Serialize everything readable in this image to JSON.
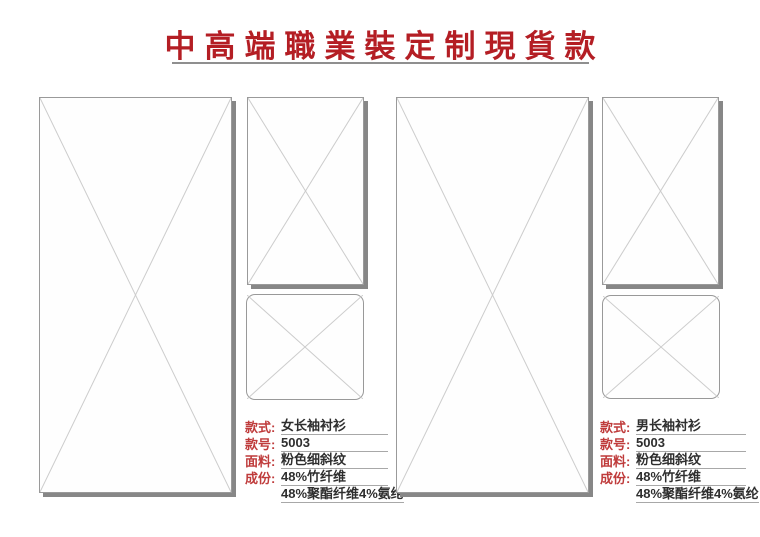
{
  "header": {
    "title": "中高端職業裝定制現貨款",
    "title_color": "#b41e24",
    "underline_color": "#8f8f8f"
  },
  "style": {
    "label_red": "#bf3b3b",
    "value_color": "#2e2e2e",
    "placeholder_border": "#9a9a9a",
    "placeholder_cross": "#cccccc",
    "placeholder_shadow": "#878787"
  },
  "placeholders": {
    "left_main": "image-placeholder",
    "left_top": "image-placeholder",
    "left_bottom": "image-placeholder-rounded",
    "right_main": "image-placeholder",
    "right_top": "image-placeholder",
    "right_bottom": "image-placeholder-rounded"
  },
  "products": [
    {
      "name": "女长袖衬衫",
      "details": [
        {
          "label": "款式:",
          "value": "女长袖衬衫"
        },
        {
          "label": "款号:",
          "value": "5003"
        },
        {
          "label": "面料:",
          "value": "粉色细斜纹"
        },
        {
          "label": "成份:",
          "value": "48%竹纤维"
        },
        {
          "label": "",
          "value": "48%聚酯纤维4%氨纶"
        }
      ]
    },
    {
      "name": "男长袖衬衫",
      "details": [
        {
          "label": "款式:",
          "value": "男长袖衬衫"
        },
        {
          "label": "款号:",
          "value": "5003"
        },
        {
          "label": "面料:",
          "value": "粉色细斜纹"
        },
        {
          "label": "成份:",
          "value": "48%竹纤维"
        },
        {
          "label": "",
          "value": "48%聚酯纤维4%氨纶"
        }
      ]
    }
  ]
}
